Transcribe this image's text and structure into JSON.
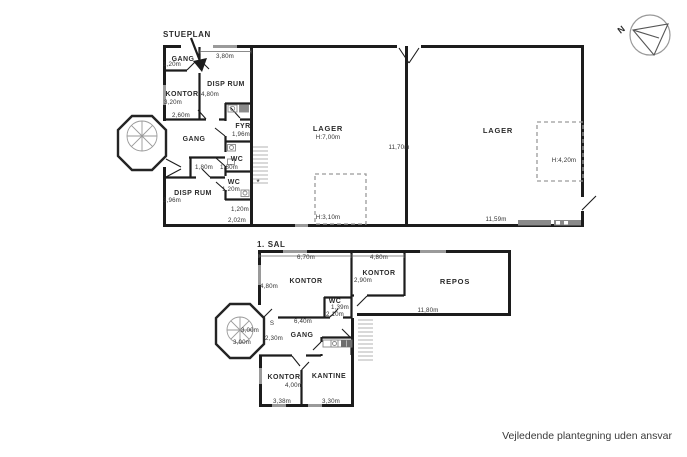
{
  "note": "Vejledende plantegning uden ansvar",
  "compass": {
    "north": "N"
  },
  "stueplan": {
    "title": "STUEPLAN",
    "gang_top": "GANG",
    "gang_top_dim": "1,20m",
    "disp_top": "DISP RUM",
    "disp_top_w": "3,80m",
    "disp_top_h": "4,80m",
    "kontor": "KONTOR",
    "kontor_h": "3,20m",
    "kontor_w": "2,60m",
    "gang_mid": "GANG",
    "fyr": "FYR",
    "fyr_dim": "1,96m",
    "wc1": "WC",
    "wc1_dim_a": "1,80m",
    "wc1_dim_b": "1,80m",
    "wc2": "WC",
    "wc2_dim": "1,20m",
    "disp_low": "DISP RUM",
    "disp_low_h": "3,96m",
    "low_dim_a": "1,20m",
    "low_dim_b": "2,02m",
    "lager_left": "LAGER",
    "lager_left_h": "H:7,00m",
    "lager_left_mezz": "H:3,10m",
    "lager_right": "LAGER",
    "lager_right_mezz": "H:4,20m",
    "lager_w": "11,59m",
    "lager_d": "11,70m",
    "star": "*"
  },
  "sal": {
    "title": "1. SAL",
    "kontor_nw": "KONTOR",
    "kontor_nw_w": "6,70m",
    "kontor_nw_h": "4,80m",
    "kontor_n": "KONTOR",
    "kontor_n_w": "4,80m",
    "kontor_n_h": "2,90m",
    "repos": "REPOS",
    "repos_w": "11,80m",
    "wc": "WC",
    "wc_dim_a": "1,39m",
    "wc_dim_b": "2,10m",
    "gang": "GANG",
    "gang_s": "S",
    "gang_w": "6,40m",
    "gang_dim": "2,30m",
    "tower_a": "3,00m",
    "tower_b": "3,00m",
    "kontor_s": "KONTOR",
    "kontor_s_dim": "4,00m",
    "kontor_s_w": "3,38m",
    "kantine": "KANTINE",
    "kantine_w": "3,30m"
  }
}
